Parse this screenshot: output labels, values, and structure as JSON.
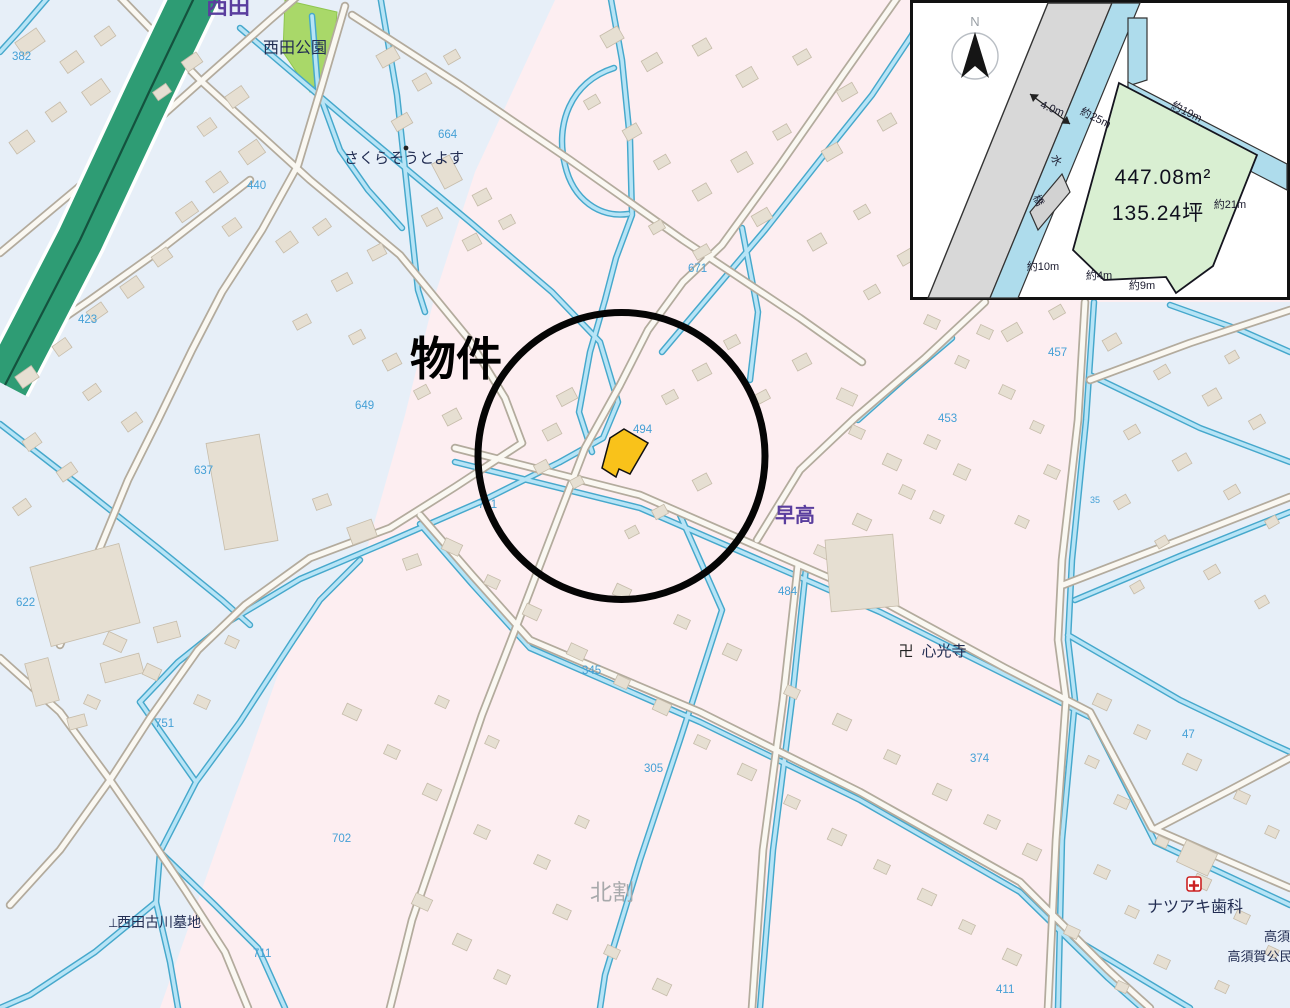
{
  "marker": {
    "label": "物件"
  },
  "labels": {
    "nishida": "西田",
    "nishida_park": "西田公園",
    "sakurasou_toyosu": "さくらそうとよす",
    "hayataka": "早高",
    "kitawari": "北割",
    "manji_symbol": "卍",
    "shinkouji": "心光寺",
    "cemetery_symbol": "⊥",
    "nishida_furukawa_cemetery": "西田古川墓地",
    "natsuaki_dental": "ナツアキ歯科",
    "takasu": "高須",
    "takasuga_kouminkan": "高須賀公民"
  },
  "parcel_numbers": {
    "n382": "382",
    "n423": "423",
    "n440": "440",
    "n453": "453",
    "n457": "457",
    "n484": "484",
    "n494": "494",
    "n622": "622",
    "n637": "637",
    "n649": "649",
    "n664": "664",
    "n671": "671",
    "n702": "702",
    "n711": "711",
    "n751": "751",
    "n761": "761",
    "n345": "345",
    "n305": "305",
    "n374": "374",
    "n47": "47",
    "n411": "411",
    "n35": "35"
  },
  "inset": {
    "north_label": "N",
    "road_width": "4.0m",
    "water_label": "水",
    "bridge_label": "橋",
    "area_sqm": "447.08m²",
    "area_tsubo": "135.24坪",
    "edge_25": "約25m",
    "edge_19": "約19m",
    "edge_21": "約21m",
    "edge_10": "約10m",
    "edge_4": "約4m",
    "edge_9": "約9m"
  },
  "colors": {
    "property_highlight": "#f9c21a",
    "marker_circle": "#050505",
    "water": "#b7e4f6",
    "residential_pink": "#fdeef1",
    "zone_blue": "#e7eff8",
    "highway_green": "#2e9c74",
    "park_green": "#a9d869",
    "plot_fill": "#d9efd2"
  }
}
